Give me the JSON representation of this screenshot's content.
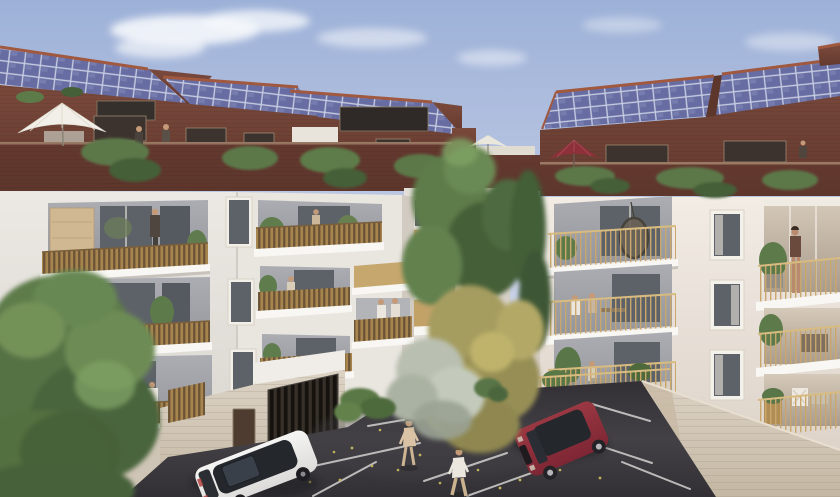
{
  "scene": {
    "title": "Architectural rendering of a residential apartment complex with rooftop solar panels and courtyard parking",
    "penthouse_level": {
      "material": "red-brick",
      "roof": "photovoltaic solar panels",
      "umbrellas": [
        "white-large-left",
        "white-small-center",
        "dark-red-right"
      ],
      "roof_terrace_people": 3,
      "planting": "trailing vines over parapet"
    },
    "left_building": {
      "balcony_style": "wood-slat railings with timber privacy screens",
      "floors_visible": 4,
      "people_on_balconies": 8
    },
    "right_building": {
      "balcony_style": "gold metal bar railings",
      "floors_visible": 4,
      "features": [
        "hanging egg chair",
        "standing woman",
        "terrace furniture",
        "potted plants"
      ]
    },
    "background_building": {
      "balcony_style": "solid gold-front rounded balconies",
      "people": 1
    },
    "vehicles": [
      {
        "type": "suv",
        "color_name": "white",
        "location": "parked by garage"
      },
      {
        "type": "suv",
        "color_name": "burgundy",
        "location": "parked in marked bay"
      }
    ],
    "parking": {
      "surface": "dark asphalt",
      "markings": "white bay lines",
      "litter": "scattered autumn leaves"
    },
    "people_walking_in_lot": 2,
    "trees": [
      "large-green-left",
      "green-center",
      "autumn-olive-center",
      "pale-silver-center",
      "hedge-by-garage"
    ],
    "ground_level": [
      "garage with dark vertical slats",
      "brown entrance door",
      "stone-clad base walls"
    ]
  },
  "colors": {
    "sky_top": "#9db1d8",
    "sky_mid": "#c6cfe6",
    "sky_low": "#e4e6ef",
    "cloud": "#f5f7fb",
    "brick": "#7a4a3c",
    "brick_dark": "#64392f",
    "brick_gable": "#5d362c",
    "terracotta": "#a0583f",
    "solar_base": "#676da2",
    "solar_cell": "#7d83b4",
    "solar_grid": "#c7cce2",
    "facade_left": "#ece9e4",
    "facade_left_shade": "#d8d4ce",
    "facade_right": "#f2ece5",
    "facade_right_shade": "#ddd3c9",
    "slab": "#f8f7f4",
    "slab_shadow": "#c7c2bb",
    "recess": "#abadb2",
    "recess_dark": "#94969c",
    "glass": "#5d6268",
    "interior_warm": "#d5c9ba",
    "wood_slat": "#a8854f",
    "wood_dark": "#6b5335",
    "screen_wood": "#cfb892",
    "gold_rail": "#c9a76c",
    "gold_rail_light": "#d8bb80",
    "base_wall": "#dcd3c5",
    "base_wall_dark": "#c4b7a3",
    "curb": "#d9d2c5",
    "asphalt": "#323034",
    "asphalt_light": "#434145",
    "line_white": "#d2d2d0",
    "leaf_yellow": "#c0b25a",
    "car_white": "#f5f5f3",
    "car_white_shade": "#dcdbd9",
    "car_glass": "#24272c",
    "car_red": "#7e2634",
    "car_red_light": "#9a3842",
    "tree_green": "#5d7b49",
    "tree_green_dark": "#455f38",
    "tree_green_light": "#7da063",
    "tree_autumn": "#a59c5e",
    "tree_autumn_light": "#bfb36c",
    "tree_pale": "#b9c0b1",
    "vine": "#5b7849",
    "umbrella_white": "#f1efe7",
    "umbrella_red": "#8e3039",
    "skin": "#c59a79",
    "person_dark": "#4a423c",
    "person_beige": "#d9c3a4",
    "person_white": "#ece7de",
    "door_brown": "#4e3c30",
    "garage_dark": "#16130f",
    "garage_slat": "#37312a",
    "shadow": "#1f1e20"
  }
}
